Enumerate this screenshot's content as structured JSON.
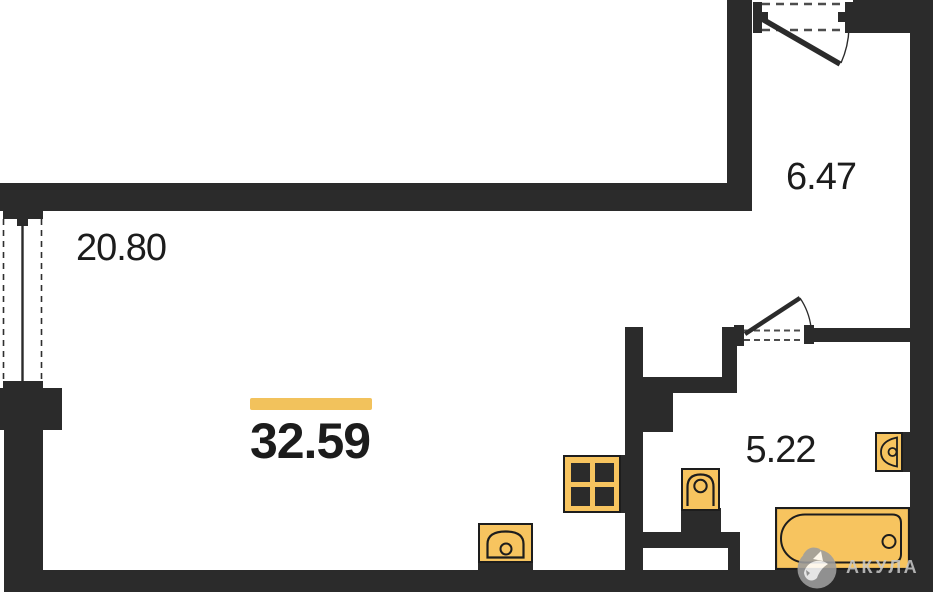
{
  "colors": {
    "background": "#ffffff",
    "wall": "#2b2b2b",
    "fixture_fill": "#f7c45f",
    "fixture_stroke": "#1d1d1d",
    "highlight": "#f2c25c",
    "label": "#1c1c1c",
    "watermark": "#c9c9c9",
    "watermark_logo": "#9e9e9e",
    "dash": "#4d4d4d"
  },
  "rooms": [
    {
      "name": "living-room",
      "label": "20.80"
    },
    {
      "name": "hallway",
      "label": "6.47"
    },
    {
      "name": "bathroom",
      "label": "5.22"
    }
  ],
  "total_area_label": "32.59",
  "watermark": {
    "text": "АКУЛА",
    "logo": "shark-logo-icon"
  },
  "fixtures": [
    {
      "icon": "stove-icon"
    },
    {
      "icon": "kitchen-sink-icon"
    },
    {
      "icon": "toilet-icon"
    },
    {
      "icon": "bathtub-icon"
    },
    {
      "icon": "washbasin-icon"
    },
    {
      "icon": "window-icon"
    },
    {
      "icon": "entrance-door-icon"
    },
    {
      "icon": "bathroom-door-icon"
    }
  ]
}
